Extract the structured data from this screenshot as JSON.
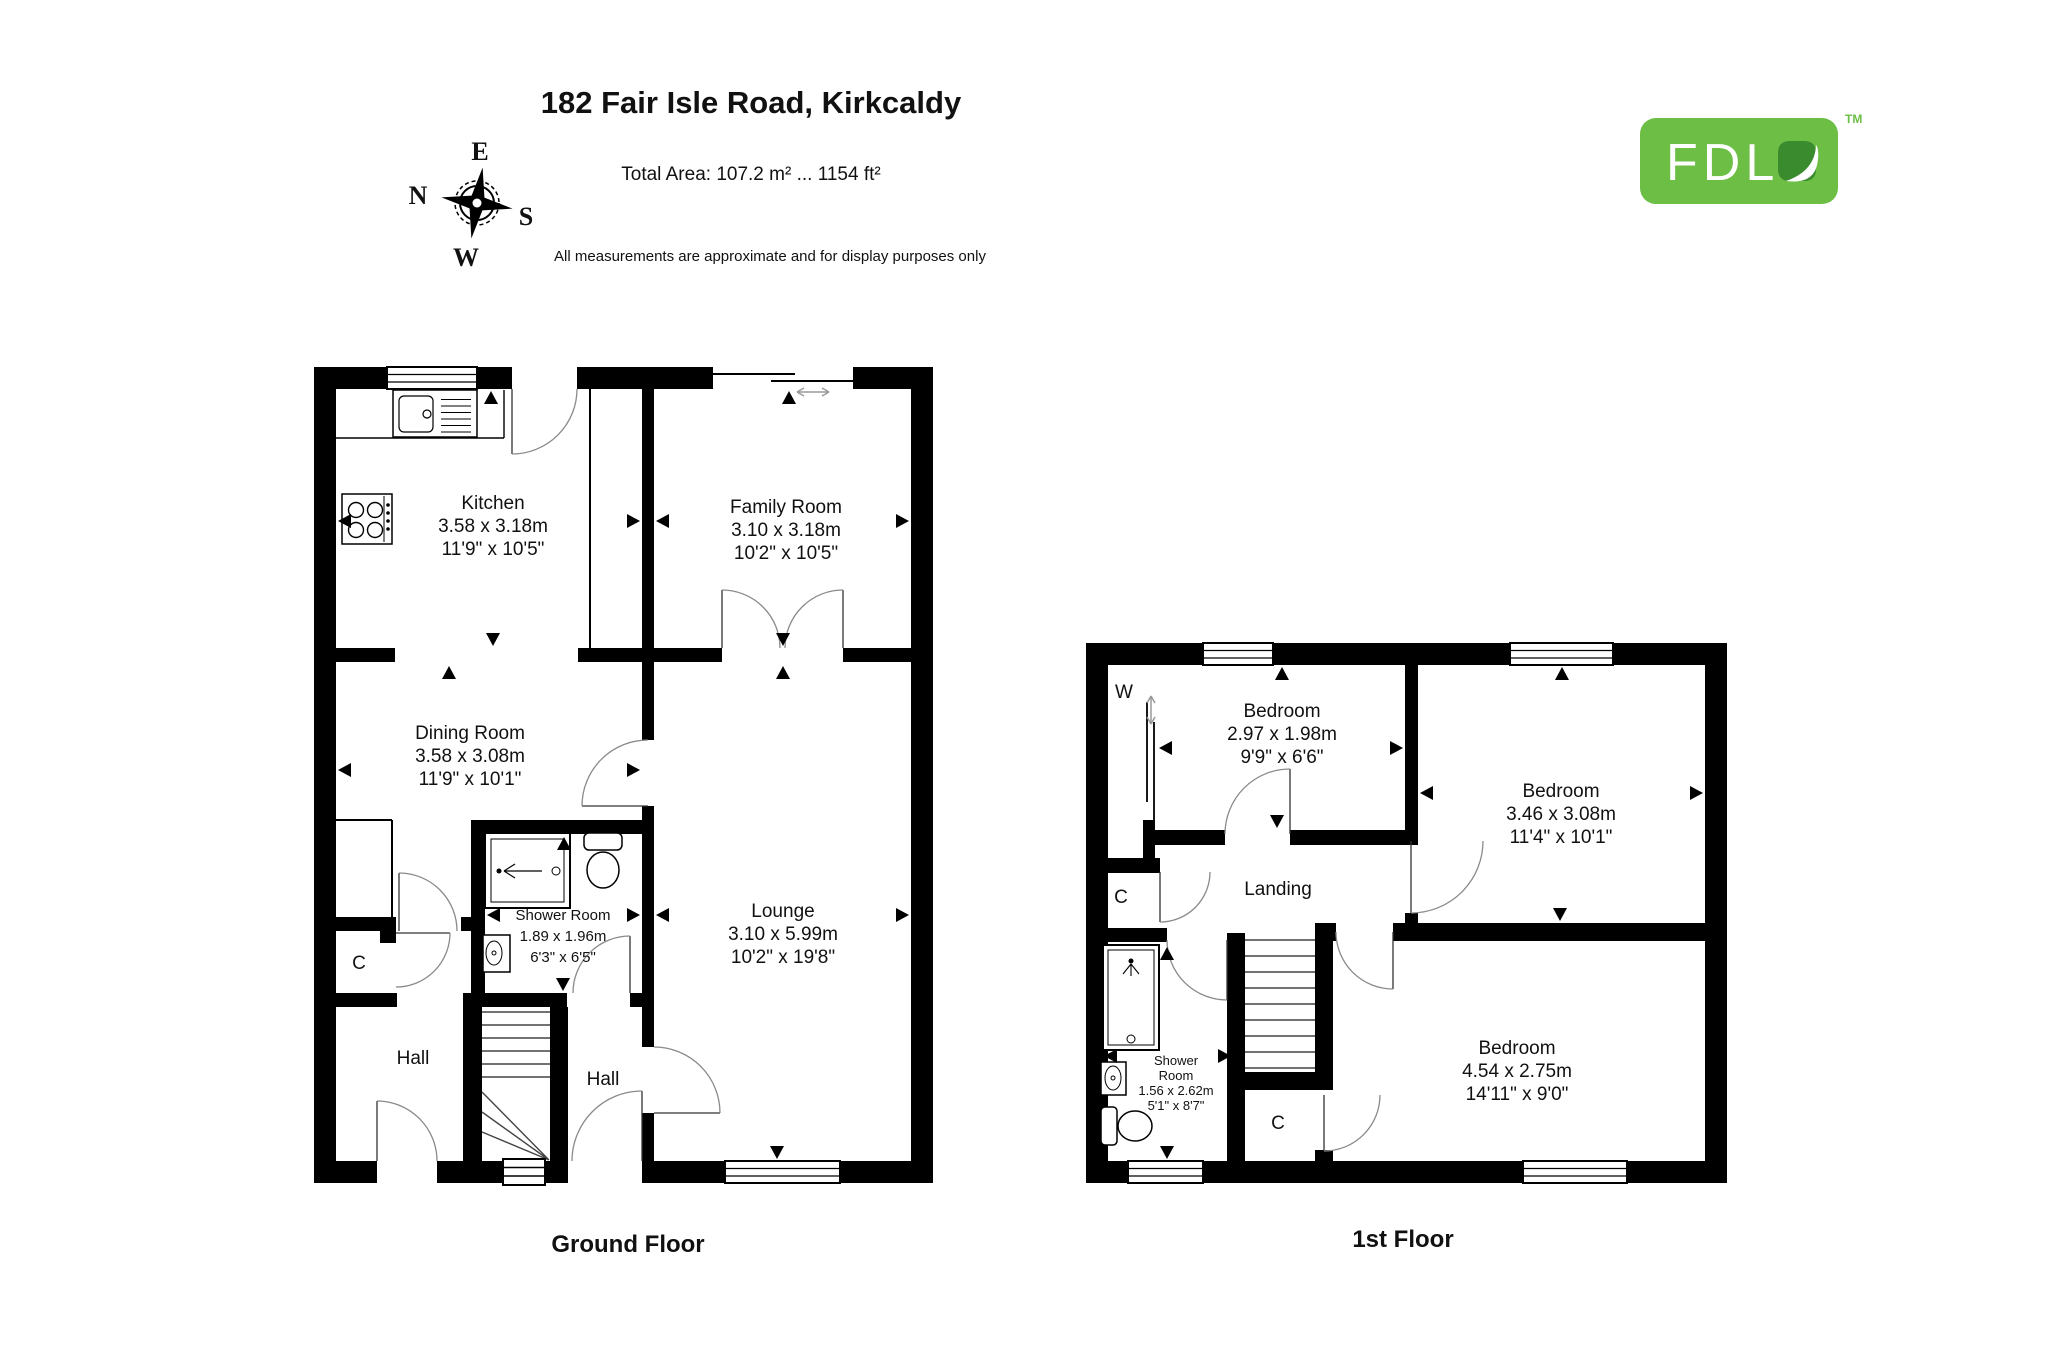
{
  "header": {
    "title": "182 Fair Isle Road, Kirkcaldy",
    "total_area": "Total Area: 107.2 m² ... 1154 ft²",
    "disclaimer": "All measurements are approximate and for display purposes only"
  },
  "logo": {
    "text": "FDL",
    "tm": "TM"
  },
  "colors": {
    "brand_green": "#6cbe45",
    "leaf_green": "#3a8a2e",
    "wall": "#000000",
    "door_arc": "#8a8a8a"
  },
  "compass": {
    "n": "N",
    "e": "E",
    "s": "S",
    "w": "W"
  },
  "floors": {
    "ground": {
      "label": "Ground Floor",
      "rooms": {
        "kitchen": {
          "name": "Kitchen",
          "metric": "3.58 x 3.18m",
          "imperial": "11'9\" x 10'5\""
        },
        "family": {
          "name": "Family Room",
          "metric": "3.10 x 3.18m",
          "imperial": "10'2\" x 10'5\""
        },
        "dining": {
          "name": "Dining Room",
          "metric": "3.58 x 3.08m",
          "imperial": "11'9\" x 10'1\""
        },
        "shower": {
          "name": "Shower Room",
          "metric": "1.89 x 1.96m",
          "imperial": "6'3\" x 6'5\""
        },
        "lounge": {
          "name": "Lounge",
          "metric": "3.10 x 5.99m",
          "imperial": "10'2\" x 19'8\""
        },
        "hall_left": {
          "name": "Hall"
        },
        "hall_right": {
          "name": "Hall"
        },
        "closet": {
          "name": "C"
        }
      }
    },
    "first": {
      "label": "1st Floor",
      "rooms": {
        "bedroom_small": {
          "name": "Bedroom",
          "metric": "2.97 x 1.98m",
          "imperial": "9'9\" x 6'6\""
        },
        "bedroom_right": {
          "name": "Bedroom",
          "metric": "3.46 x 3.08m",
          "imperial": "11'4\" x 10'1\""
        },
        "bedroom_bottom": {
          "name": "Bedroom",
          "metric": "4.54 x 2.75m",
          "imperial": "14'11\" x 9'0\""
        },
        "landing": {
          "name": "Landing"
        },
        "shower": {
          "line1": "Shower",
          "line2": "Room",
          "metric": "1.56 x 2.62m",
          "imperial": "5'1\" x 8'7\""
        },
        "wardrobe": {
          "name": "W"
        },
        "closet_left": {
          "name": "C"
        },
        "closet_bottom": {
          "name": "C"
        }
      }
    }
  }
}
